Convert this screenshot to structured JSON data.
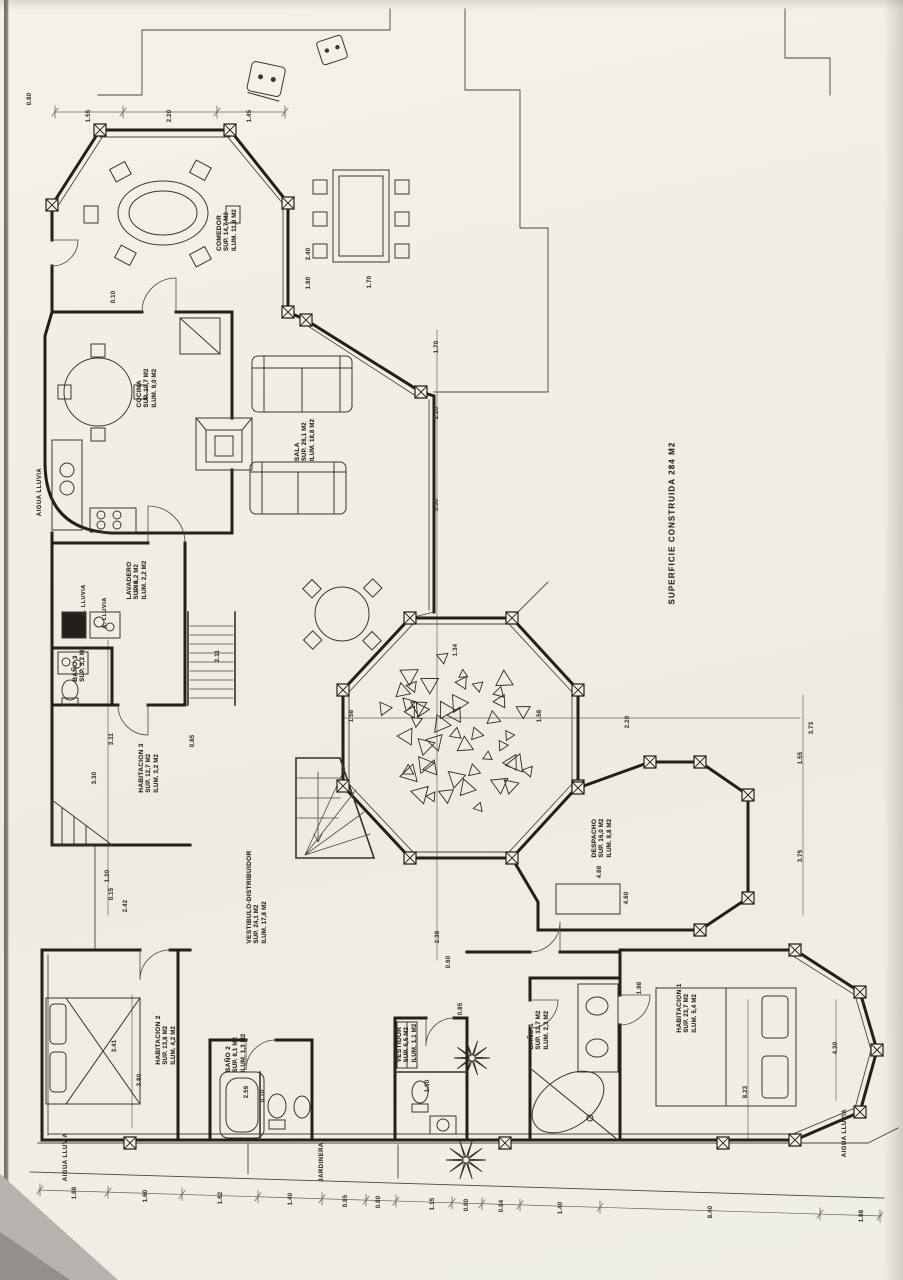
{
  "document": {
    "kind": "scanned architectural floor plan",
    "orientation_note": "all lettering reads bottom-to-top (rotated 90°)"
  },
  "superficie": {
    "text": "SUPERFICIE CONSTRUIDA  284 M2",
    "x": 672,
    "y": 523
  },
  "rooms": [
    {
      "name": "COMEDOR",
      "sup": "SUP. 14,7 M2",
      "ilum": "ILUM. 11,8 M2",
      "x": 228,
      "y": 230
    },
    {
      "name": "COCINA",
      "sup": "SUP. 10,7 M2",
      "ilum": "ILUM. 9,0 M2",
      "x": 148,
      "y": 388
    },
    {
      "name": "SALA",
      "sup": "SUP. 26,1 M2",
      "ilum": "ILUM. 18,8 M2",
      "x": 306,
      "y": 440
    },
    {
      "name": "LAVADERO",
      "sup": "SUP. 6,2 M2",
      "ilum": "ILUM. 2,2 M2",
      "x": 138,
      "y": 580
    },
    {
      "name": "BAÑO 3",
      "sup": "SUP. 3,2 M2",
      "ilum": "",
      "x": 80,
      "y": 664
    },
    {
      "name": "HABITACION 3",
      "sup": "SUP. 12,7 M2",
      "ilum": "ILUM. 3,2 M2",
      "x": 150,
      "y": 768
    },
    {
      "name": "VESTIBULO-DISTRIBUIDOR",
      "sup": "SUP. 24,1 M2",
      "ilum": "ILUM. 17,8 M2",
      "x": 258,
      "y": 897
    },
    {
      "name": "DESPACHO",
      "sup": "SUP. 16,0 M2",
      "ilum": "ILUM. 8,8 M2",
      "x": 603,
      "y": 838
    },
    {
      "name": "HABITACION 1",
      "sup": "SUP. 23,7 M2",
      "ilum": "ILUM. 5,4 M2",
      "x": 688,
      "y": 1008
    },
    {
      "name": "BAÑO 1",
      "sup": "SUP. 12,7 M2",
      "ilum": "ILUM. 2,3 M2",
      "x": 540,
      "y": 1030
    },
    {
      "name": "VESTIDOR",
      "sup": "SUP. 5,5 M2",
      "ilum": "ILUM. 1,1 M2",
      "x": 408,
      "y": 1043
    },
    {
      "name": "HABITACION 2",
      "sup": "SUP. 13,8 M2",
      "ilum": "ILUM. 4,2 M2",
      "x": 167,
      "y": 1040
    },
    {
      "name": "BAÑO 2",
      "sup": "SUP. 6,1 M2",
      "ilum": "ILUM. 1,3 M2",
      "x": 237,
      "y": 1053
    }
  ],
  "annotations": [
    {
      "text": "AIGUA LLUVIA",
      "x": 40,
      "y": 492,
      "size": 6
    },
    {
      "text": "A. LLUVIA",
      "x": 84,
      "y": 600,
      "size": 5.5
    },
    {
      "text": "A. LLUVIA",
      "x": 105,
      "y": 613,
      "size": 5.5
    },
    {
      "text": "AIGUA LLUVIA",
      "x": 66,
      "y": 1157,
      "size": 6
    },
    {
      "text": "AIGUA LLUVIA",
      "x": 845,
      "y": 1133,
      "size": 6
    },
    {
      "text": "JARDINERA",
      "x": 322,
      "y": 1162,
      "size": 6
    }
  ],
  "dimensions": [
    {
      "value": "0.80",
      "x": 30,
      "y": 99
    },
    {
      "value": "1.55",
      "x": 89,
      "y": 116
    },
    {
      "value": "2.20",
      "x": 170,
      "y": 116
    },
    {
      "value": "1.45",
      "x": 250,
      "y": 116
    },
    {
      "value": "1.70",
      "x": 370,
      "y": 282
    },
    {
      "value": "2.40",
      "x": 309,
      "y": 254
    },
    {
      "value": "1.80",
      "x": 309,
      "y": 283
    },
    {
      "value": "0.10",
      "x": 114,
      "y": 297
    },
    {
      "value": "1.70",
      "x": 437,
      "y": 347
    },
    {
      "value": "2.20",
      "x": 437,
      "y": 413
    },
    {
      "value": "5.50",
      "x": 437,
      "y": 505
    },
    {
      "value": "1.34",
      "x": 456,
      "y": 650
    },
    {
      "value": "2.38",
      "x": 438,
      "y": 937
    },
    {
      "value": "0.60",
      "x": 449,
      "y": 962
    },
    {
      "value": "0.85",
      "x": 461,
      "y": 1009
    },
    {
      "value": "1.40",
      "x": 137,
      "y": 587
    },
    {
      "value": "2.11",
      "x": 218,
      "y": 656
    },
    {
      "value": "3.11",
      "x": 112,
      "y": 739
    },
    {
      "value": "3.30",
      "x": 95,
      "y": 778
    },
    {
      "value": "0.85",
      "x": 193,
      "y": 741
    },
    {
      "value": "1.20",
      "x": 108,
      "y": 876
    },
    {
      "value": "0.15",
      "x": 112,
      "y": 894
    },
    {
      "value": "2.42",
      "x": 126,
      "y": 906
    },
    {
      "value": "1.58",
      "x": 352,
      "y": 716
    },
    {
      "value": "1.58",
      "x": 540,
      "y": 716
    },
    {
      "value": "2.20",
      "x": 628,
      "y": 722
    },
    {
      "value": "3.73",
      "x": 812,
      "y": 728
    },
    {
      "value": "1.55",
      "x": 801,
      "y": 758
    },
    {
      "value": "3.75",
      "x": 801,
      "y": 856
    },
    {
      "value": "4.88",
      "x": 600,
      "y": 872
    },
    {
      "value": "4.60",
      "x": 627,
      "y": 898
    },
    {
      "value": "1.98",
      "x": 640,
      "y": 988
    },
    {
      "value": "3.41",
      "x": 115,
      "y": 1046
    },
    {
      "value": "3.80",
      "x": 140,
      "y": 1080
    },
    {
      "value": "2.59",
      "x": 247,
      "y": 1092
    },
    {
      "value": "0.10",
      "x": 263,
      "y": 1096
    },
    {
      "value": "1.30",
      "x": 428,
      "y": 1086
    },
    {
      "value": "4.30",
      "x": 836,
      "y": 1048
    },
    {
      "value": "8.23",
      "x": 746,
      "y": 1092
    },
    {
      "value": "1.88",
      "x": 75,
      "y": 1193
    },
    {
      "value": "1.60",
      "x": 146,
      "y": 1196
    },
    {
      "value": "1.62",
      "x": 221,
      "y": 1198
    },
    {
      "value": "1.40",
      "x": 291,
      "y": 1199
    },
    {
      "value": "0.85",
      "x": 346,
      "y": 1201
    },
    {
      "value": "0.80",
      "x": 379,
      "y": 1202
    },
    {
      "value": "1.15",
      "x": 433,
      "y": 1204
    },
    {
      "value": "0.80",
      "x": 467,
      "y": 1205
    },
    {
      "value": "0.94",
      "x": 502,
      "y": 1206
    },
    {
      "value": "1.40",
      "x": 561,
      "y": 1208
    },
    {
      "value": "8.40",
      "x": 711,
      "y": 1212
    },
    {
      "value": "1.88",
      "x": 862,
      "y": 1216
    }
  ],
  "colors": {
    "paper": "#f1eee8",
    "ink": "#23201c",
    "thin_ink": "#4a463f",
    "dim_ink": "#6b665e"
  }
}
